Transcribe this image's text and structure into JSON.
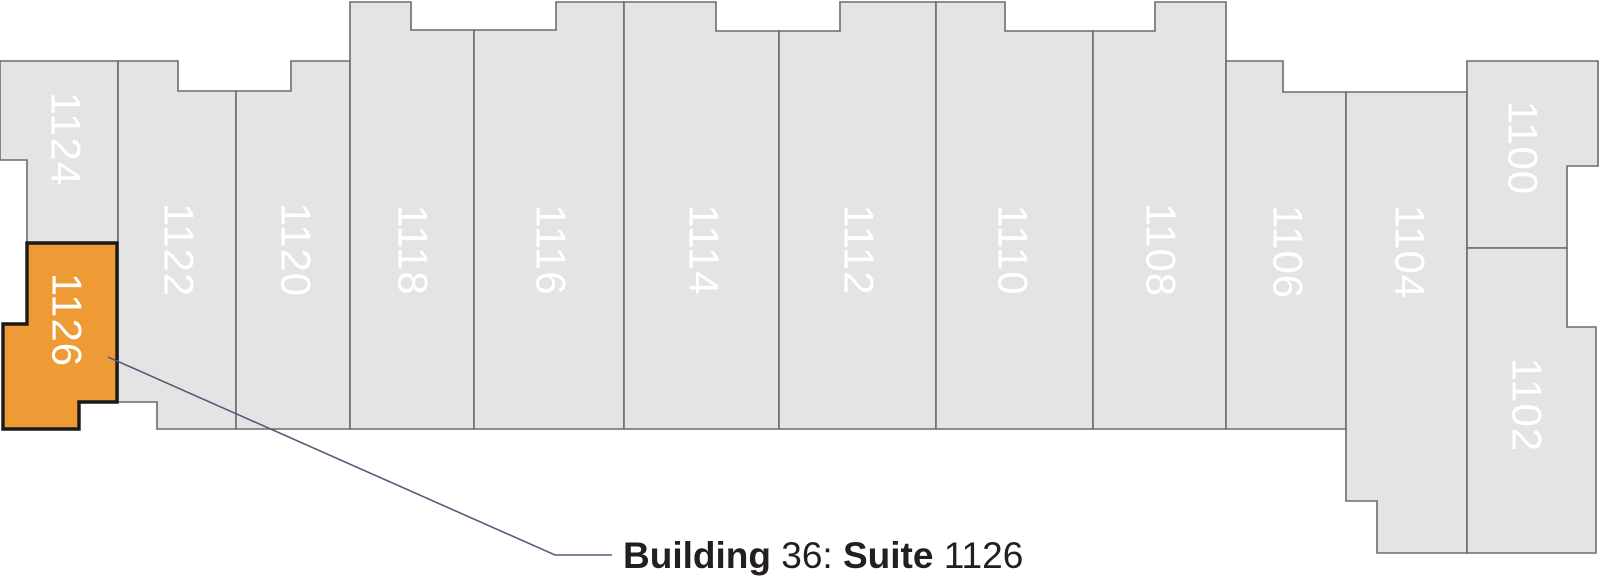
{
  "canvas": {
    "width": 1600,
    "height": 587,
    "background": "#ffffff"
  },
  "colors": {
    "suite_fill": "#e4e4e5",
    "suite_stroke": "#6b6c6f",
    "highlight_fill": "#ee9a35",
    "highlight_stroke": "#1a1a1a",
    "suite_label_text": "#ffffff",
    "leader_line": "#525e78",
    "callout_text": "#231f20"
  },
  "callout": {
    "full_text": "Building 36: Suite 1126",
    "x": 623,
    "baseline_y": 568,
    "parts": [
      {
        "text": "Building ",
        "bold": true
      },
      {
        "text": "36: ",
        "bold": false
      },
      {
        "text": "Suite ",
        "bold": true
      },
      {
        "text": "1126",
        "bold": false
      }
    ]
  },
  "leader": {
    "points": "108,357 555,555 612,555"
  },
  "suites": [
    {
      "number": "1124",
      "highlighted": false,
      "polygon": "0,61 118,61 118,243 27,243 27,160 0,160",
      "label": {
        "x": 66,
        "y": 139,
        "rotation": 90
      }
    },
    {
      "number": "1122",
      "highlighted": false,
      "polygon": "118,61 178,61 178,91 236,91 236,429 157,429 157,402 118,402",
      "label": {
        "x": 179,
        "y": 250,
        "rotation": 90
      }
    },
    {
      "number": "1120",
      "highlighted": false,
      "polygon": "236,91 291,91 291,61 350,61 350,429 236,429",
      "label": {
        "x": 296,
        "y": 250,
        "rotation": 90
      }
    },
    {
      "number": "1118",
      "highlighted": false,
      "polygon": "350,2 411,2 411,30 474,30 474,429 350,429",
      "label": {
        "x": 413,
        "y": 250,
        "rotation": 90
      }
    },
    {
      "number": "1116",
      "highlighted": false,
      "polygon": "474,30 556,30 556,2 624,2 624,429 474,429",
      "label": {
        "x": 551,
        "y": 250,
        "rotation": 90
      }
    },
    {
      "number": "1114",
      "highlighted": false,
      "polygon": "624,2 716,2 716,31 779,31 779,429 624,429",
      "label": {
        "x": 704,
        "y": 250,
        "rotation": 90
      }
    },
    {
      "number": "1112",
      "highlighted": false,
      "polygon": "779,31 840,31 840,2 936,2 936,429 779,429",
      "label": {
        "x": 859,
        "y": 250,
        "rotation": 90
      }
    },
    {
      "number": "1110",
      "highlighted": false,
      "polygon": "936,2 1005,2 1005,31 1093,31 1093,429 936,429",
      "label": {
        "x": 1013,
        "y": 250,
        "rotation": 90
      }
    },
    {
      "number": "1108",
      "highlighted": false,
      "polygon": "1093,31 1155,31 1155,2 1226,2 1226,429 1093,429",
      "label": {
        "x": 1161,
        "y": 250,
        "rotation": 90
      }
    },
    {
      "number": "1106",
      "highlighted": false,
      "polygon": "1226,61 1283,61 1283,92 1346,92 1346,429 1226,429",
      "label": {
        "x": 1288,
        "y": 252,
        "rotation": 90
      }
    },
    {
      "number": "1104",
      "highlighted": false,
      "polygon": "1346,92 1467,92 1467,553 1377,553 1377,501 1346,501",
      "label": {
        "x": 1410,
        "y": 252,
        "rotation": 90
      }
    },
    {
      "number": "1100",
      "highlighted": false,
      "polygon": "1467,61 1598,61 1598,166 1567,166 1567,248 1467,248",
      "label": {
        "x": 1523,
        "y": 148,
        "rotation": 90
      }
    },
    {
      "number": "1102",
      "highlighted": false,
      "polygon": "1467,248 1567,248 1567,327 1596,327 1596,553 1467,553",
      "label": {
        "x": 1527,
        "y": 405,
        "rotation": 90
      }
    },
    {
      "number": "1126",
      "highlighted": true,
      "polygon": "27,243 117,243 117,402 79,402 79,429 3,429 3,324 27,324",
      "label": {
        "x": 67,
        "y": 320,
        "rotation": 90
      }
    }
  ]
}
